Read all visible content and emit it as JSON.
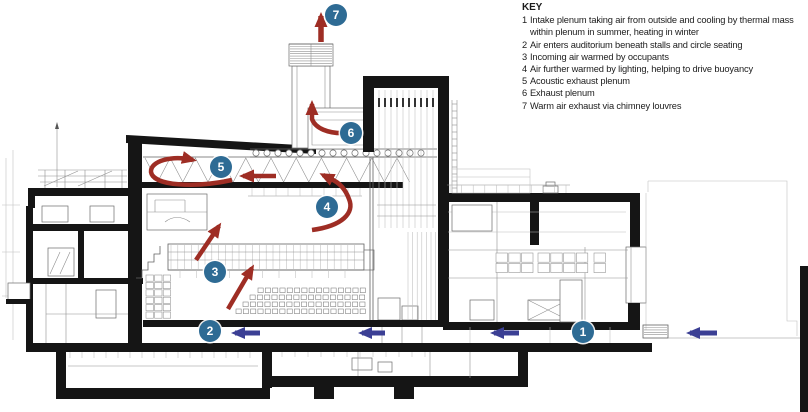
{
  "figure": {
    "type": "architectural-section-airflow-diagram",
    "subject": "Theatre section showing natural ventilation strategy"
  },
  "key": {
    "title": "KEY",
    "items": [
      {
        "num": "1",
        "text": "Intake plenum taking air from outside and cooling by thermal mass within plenum in summer, heating in winter"
      },
      {
        "num": "2",
        "text": "Air enters auditorium beneath stalls and circle seating"
      },
      {
        "num": "3",
        "text": "Incoming air warmed by occupants"
      },
      {
        "num": "4",
        "text": "Air further warmed by lighting, helping to drive buoyancy"
      },
      {
        "num": "5",
        "text": "Acoustic exhaust plenum"
      },
      {
        "num": "6",
        "text": "Exhaust plenum"
      },
      {
        "num": "7",
        "text": "Warm air exhaust via chimney louvres"
      }
    ]
  },
  "badges": [
    {
      "num": "1",
      "x": 583,
      "y": 332
    },
    {
      "num": "2",
      "x": 210,
      "y": 331
    },
    {
      "num": "3",
      "x": 215,
      "y": 272
    },
    {
      "num": "4",
      "x": 327,
      "y": 207
    },
    {
      "num": "5",
      "x": 221,
      "y": 167
    },
    {
      "num": "6",
      "x": 351,
      "y": 133
    },
    {
      "num": "7",
      "x": 336,
      "y": 15
    }
  ],
  "colors": {
    "badge_blue": "#2e6b94",
    "warm_air_red": "#9e2d24",
    "cool_air_blue": "#3b3f94",
    "linework_gray": "#636363",
    "poche_black": "#151515"
  }
}
